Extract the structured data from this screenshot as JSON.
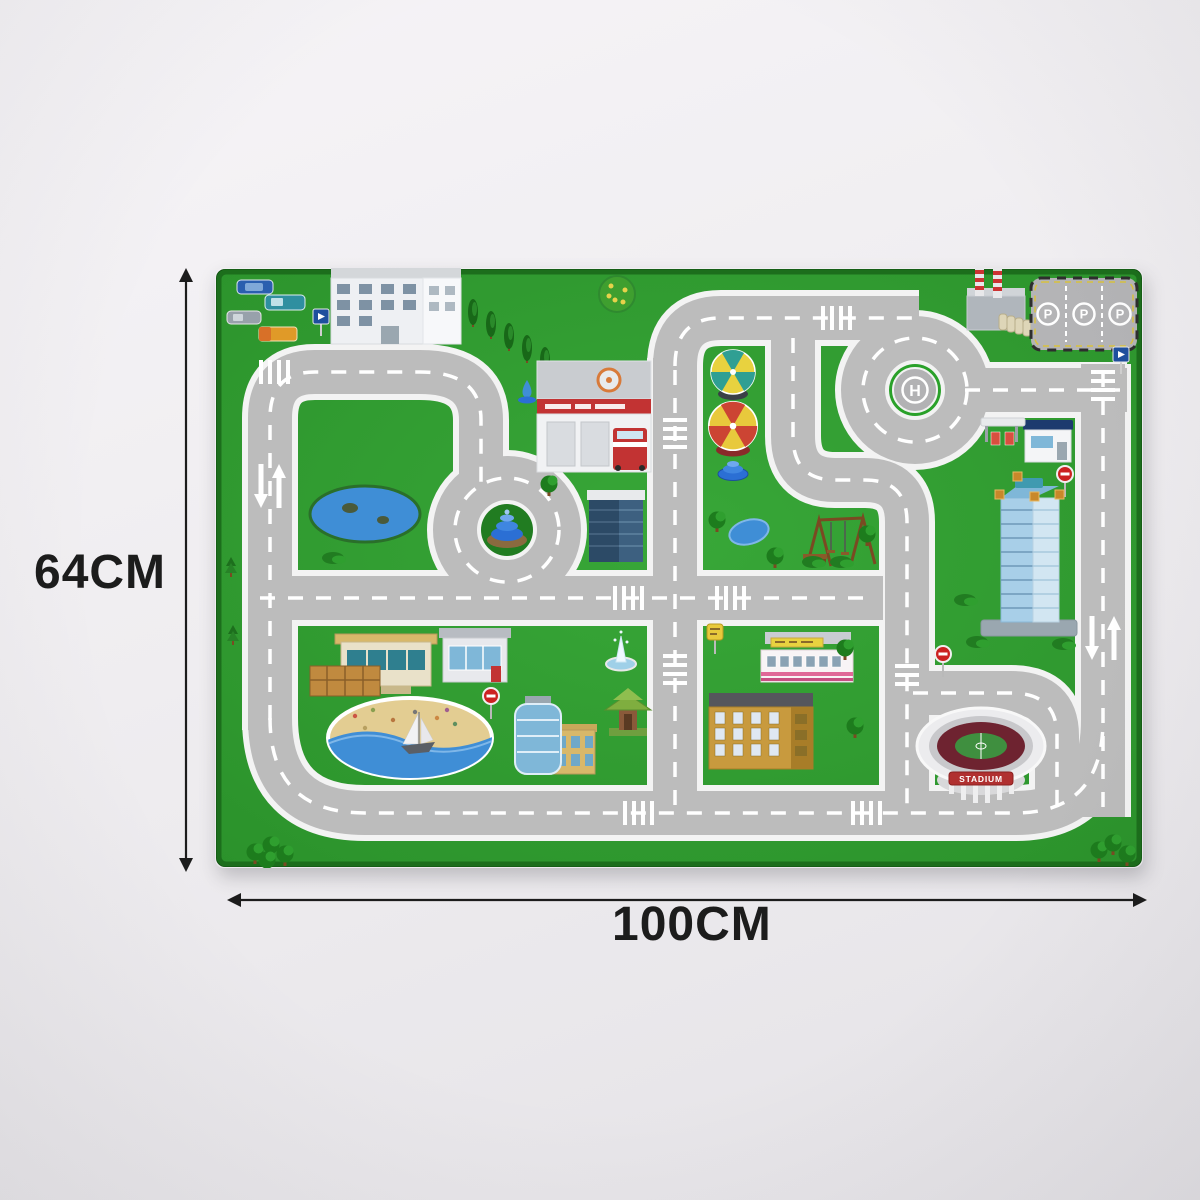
{
  "annotations": {
    "height_label": "64CM",
    "width_label": "100CM"
  },
  "mat": {
    "helipad_letter": "H",
    "parking_spaces": [
      "P",
      "P",
      "P"
    ],
    "stadium_label": "STADIUM",
    "landmarks": [
      "cars-cluster",
      "apartment-building",
      "fire-station",
      "fire-truck",
      "helipad",
      "parking-lot",
      "factory",
      "gas-station",
      "office-tower",
      "skyscraper",
      "roundabout-fountain",
      "carousel-teal",
      "carousel-red",
      "park-fountain",
      "playground",
      "pond",
      "beach",
      "sailboat",
      "stadium",
      "restaurant",
      "showroom",
      "glass-building",
      "pagoda-kiosk",
      "geyser-fountain",
      "pink-store",
      "yellow-apartment",
      "trees"
    ]
  },
  "colors": {
    "mat_green": "#2f9c2f",
    "mat_border": "#1c6e1c",
    "road_fill": "#bcbcbc",
    "road_edge": "#f3f3f3",
    "marking_white": "#ffffff",
    "background": "#efedf0",
    "annotation_ink": "#1c1c1c",
    "water_blue": "#3f8ed6",
    "sand": "#e3cd92",
    "stadium_seats": "#6e2330",
    "banner_red": "#b03030"
  }
}
